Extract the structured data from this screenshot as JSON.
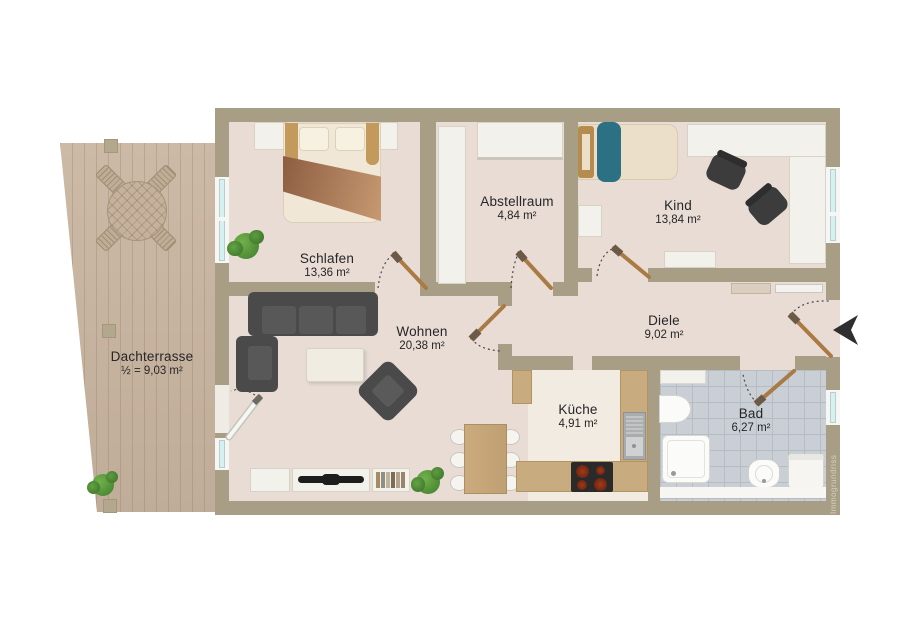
{
  "plan_type": "apartment-floor-plan",
  "watermark": "Immogrundriss",
  "rooms": {
    "dachterrasse": {
      "name": "Dachterrasse",
      "area": "½ = 9,03 m²"
    },
    "schlafen": {
      "name": "Schlafen",
      "area": "13,36 m²"
    },
    "abstellraum": {
      "name": "Abstellraum",
      "area": "4,84 m²"
    },
    "kind": {
      "name": "Kind",
      "area": "13,84 m²"
    },
    "wohnen": {
      "name": "Wohnen",
      "area": "20,38 m²"
    },
    "diele": {
      "name": "Diele",
      "area": "9,02 m²"
    },
    "kueche": {
      "name": "Küche",
      "area": "4,91 m²"
    },
    "bad": {
      "name": "Bad",
      "area": "6,27 m²"
    }
  },
  "colors": {
    "wall": "#a89d85",
    "floor": "#e8dcd5",
    "kitchen_floor": "#f2ebe2",
    "bath_tile": "#c9cfd5",
    "terrace_wood": "#c9b6a2",
    "counter": "#c8ac7f",
    "door_leaf": "#aa7a44",
    "accent_teal": "#2c7084",
    "furniture_dark": "#4a4a4a",
    "window_glass": "#d6f1f0"
  }
}
